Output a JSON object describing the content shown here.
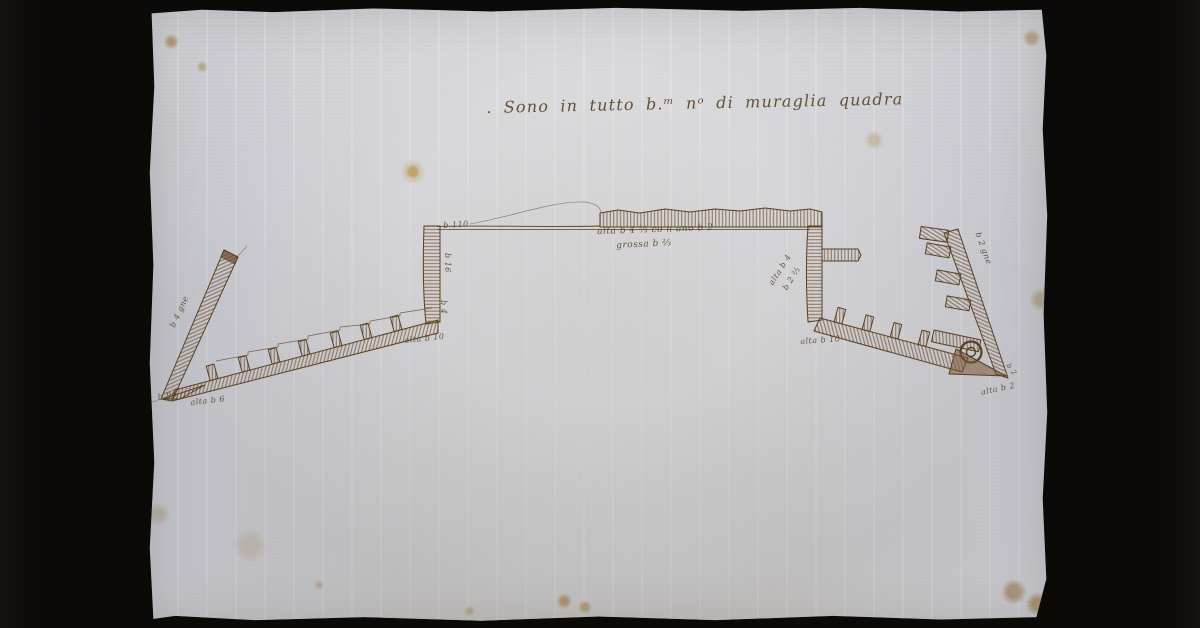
{
  "scene": {
    "background_color": "#0b0a09",
    "paper_color": "#cbcbd1",
    "ink_color": "#6b4a2a",
    "description": "Manuscript ink plan of a square fortification wall with two corner bastions on aged laid paper"
  },
  "inscription": {
    "title": ". Sono in tutto b.ᵐ nᵒ di muraglia quadra"
  },
  "annotations": [
    {
      "id": "top-wall-left-measure",
      "text": "b 110"
    },
    {
      "id": "curtain-height",
      "text": "alta b 4 ⅔ co n ano b 2"
    },
    {
      "id": "curtain-thickness",
      "text": "grossa b ⅔"
    },
    {
      "id": "left-wall-upper-measure",
      "text": "b 16"
    },
    {
      "id": "left-wall-lower-measure",
      "text": "b 4"
    },
    {
      "id": "left-rampart-height",
      "text": "alta b 10"
    },
    {
      "id": "left-base-length",
      "text": "b 90"
    },
    {
      "id": "left-base-height",
      "text": "alta b 6"
    },
    {
      "id": "left-bastion-face",
      "text": "b 4 gne"
    },
    {
      "id": "right-corner-measure-1",
      "text": "alta b 4"
    },
    {
      "id": "right-corner-measure-2",
      "text": "b 2 ⅔"
    },
    {
      "id": "right-rampart-height",
      "text": "alta b 10"
    },
    {
      "id": "right-bastion-face",
      "text": "b 2 gne"
    },
    {
      "id": "right-apex-measure",
      "text": "b 2"
    },
    {
      "id": "right-apex-height",
      "text": "alta b 2"
    }
  ]
}
